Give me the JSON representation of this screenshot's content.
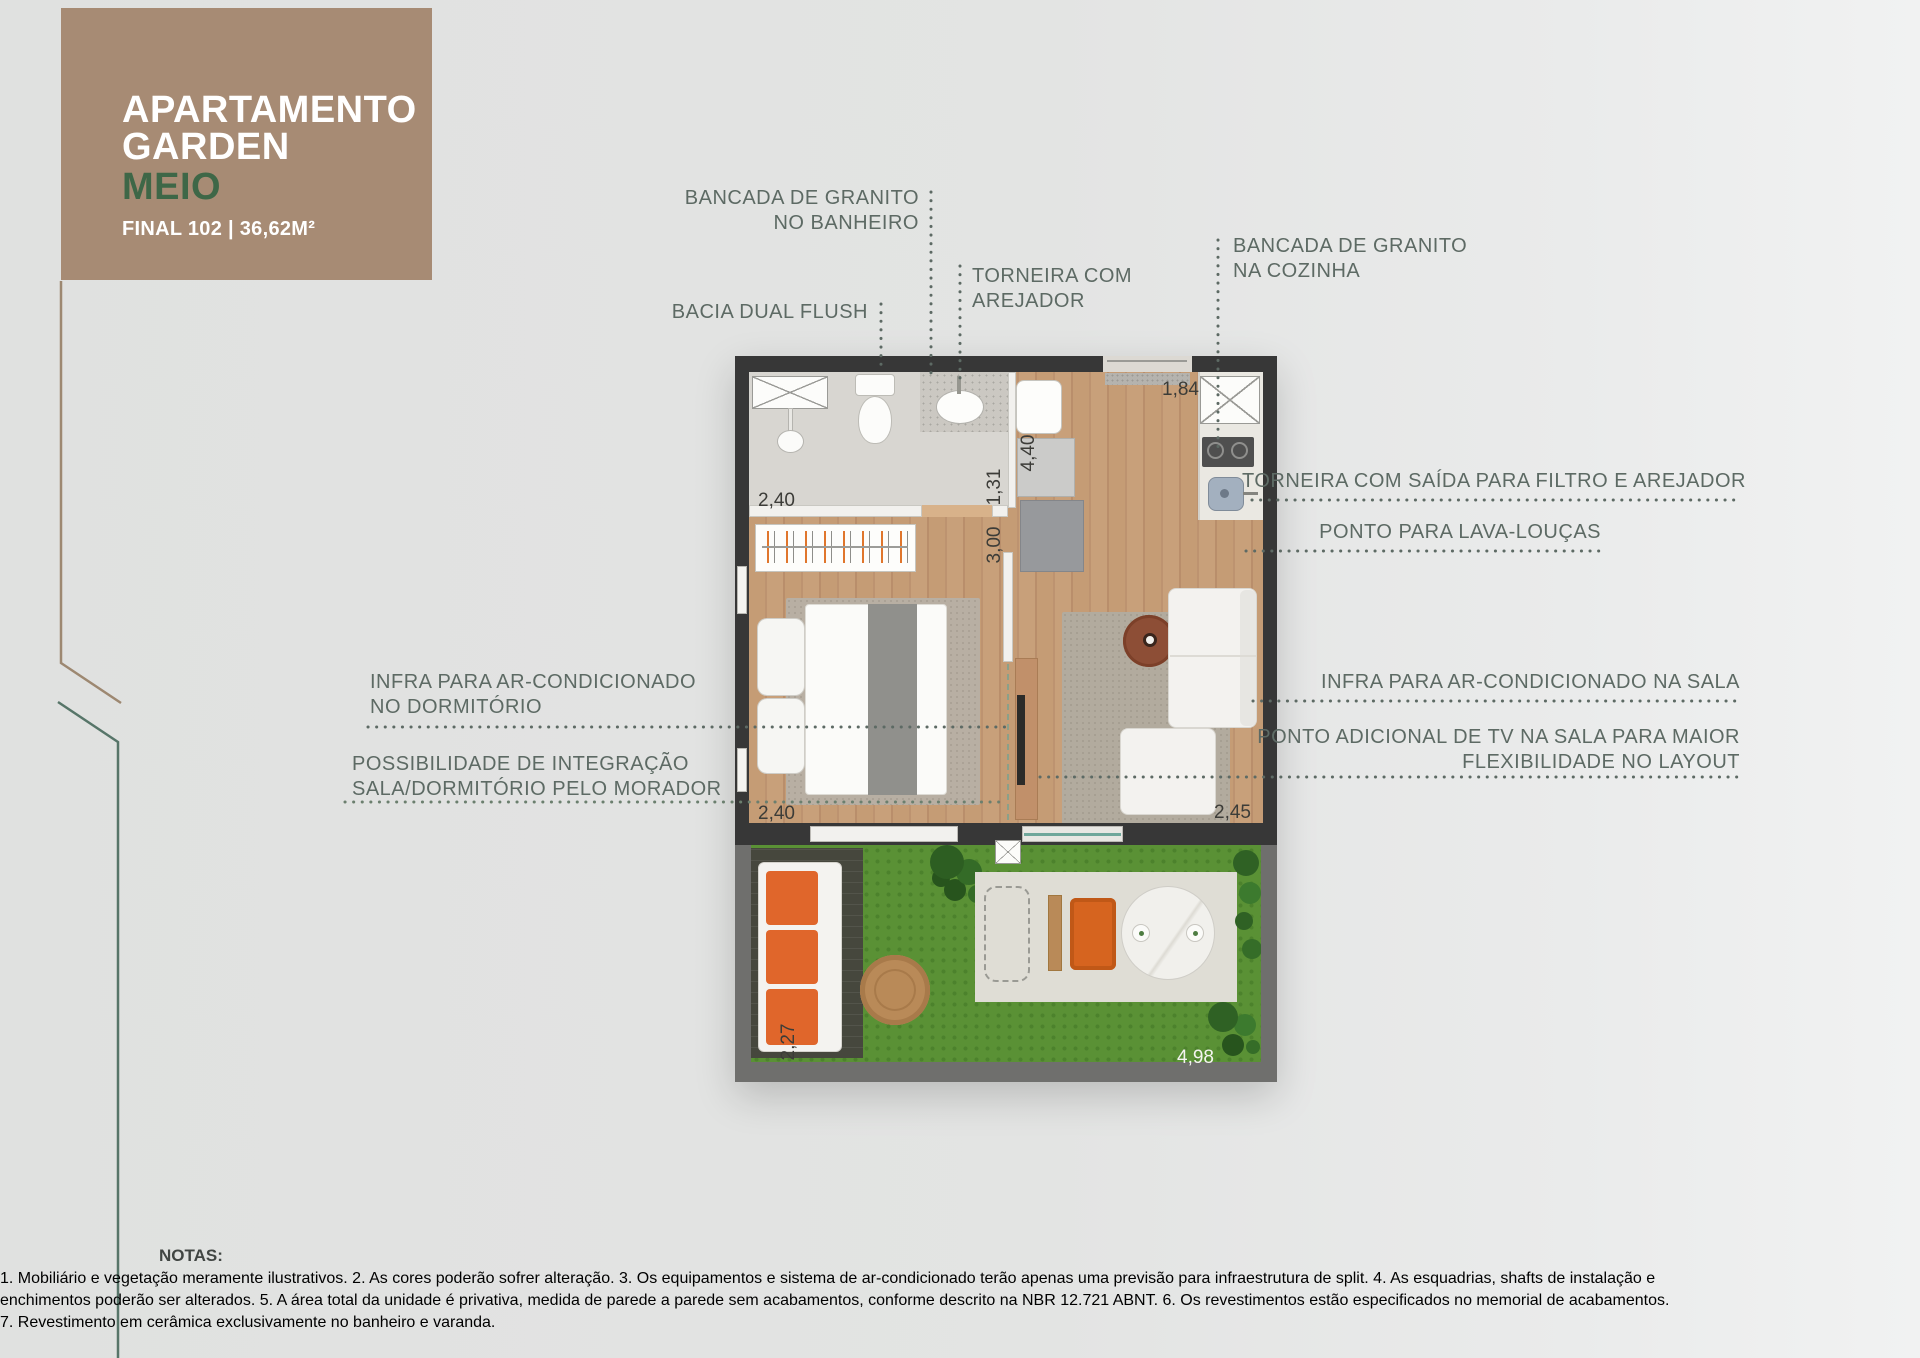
{
  "header": {
    "title_line1": "APARTAMENTO",
    "title_line2": "GARDEN",
    "variant": "MEIO",
    "subtitle": "FINAL 102 | 36,62M²"
  },
  "callouts": {
    "bancada_banheiro": {
      "lines": [
        "BANCADA DE GRANITO",
        "NO BANHEIRO"
      ]
    },
    "bacia_dual_flush": {
      "lines": [
        "BACIA DUAL FLUSH"
      ]
    },
    "torneira_arejador": {
      "lines": [
        "TORNEIRA COM",
        "AREJADOR"
      ]
    },
    "bancada_cozinha": {
      "lines": [
        "BANCADA DE GRANITO",
        "NA COZINHA"
      ]
    },
    "torneira_filtro": {
      "lines": [
        "TORNEIRA COM SAÍDA PARA FILTRO E AREJADOR"
      ]
    },
    "lava_loucas": {
      "lines": [
        "PONTO PARA LAVA-LOUÇAS"
      ]
    },
    "infra_sala": {
      "lines": [
        "INFRA PARA AR-CONDICIONADO NA SALA"
      ]
    },
    "ponto_tv": {
      "lines": [
        "PONTO ADICIONAL DE TV NA SALA PARA MAIOR",
        "FLEXIBILIDADE NO LAYOUT"
      ]
    },
    "infra_dormitorio": {
      "lines": [
        "INFRA PARA AR-CONDICIONADO",
        "NO DORMITÓRIO"
      ]
    },
    "integracao": {
      "lines": [
        "POSSIBILIDADE DE INTEGRAÇÃO",
        "SALA/DORMITÓRIO PELO MORADOR"
      ]
    }
  },
  "dimensions": {
    "bathroom_width": "2,40",
    "hall_depth": "1,31",
    "room_depth": "3,00",
    "kitchen_depth": "4,40",
    "entry_width": "1,84",
    "bedroom_width": "2,40",
    "living_width": "2,45",
    "garden_depth": "2,27",
    "garden_width": "4,98"
  },
  "notes": {
    "title": "NOTAS:",
    "lines": [
      "1. Mobiliário e vegetação meramente ilustrativos. 2. As cores poderão sofrer alteração. 3. Os equipamentos e sistema de ar-condicionado terão apenas uma previsão para infraestrutura de split. 4. As esquadrias, shafts de instalação e",
      "enchimentos poderão ser alterados. 5. A área total da unidade é privativa, medida de parede a parede sem acabamentos, conforme descrito na NBR 12.721 ABNT. 6. Os revestimentos estão especificados no memorial de acabamentos.",
      "7. Revestimento em cerâmica exclusivamente no banheiro e varanda."
    ]
  },
  "colors": {
    "brand_brown": "#a78b74",
    "brand_green": "#3e6747",
    "label_green_gray": "#5d6a64",
    "wall_dark": "#373737",
    "grass": "#5a9135",
    "accent_orange": "#e0662b"
  }
}
